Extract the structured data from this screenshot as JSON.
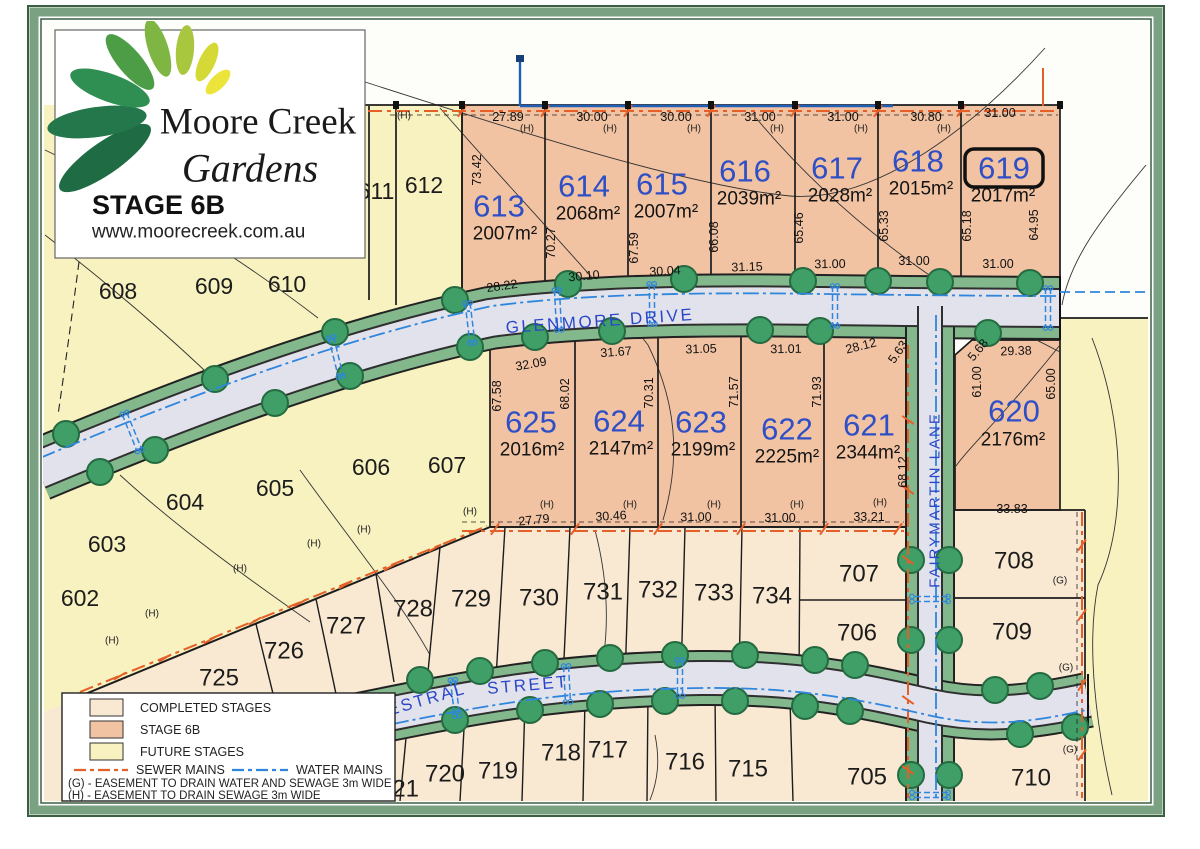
{
  "title_block": {
    "brand_line1": "Moore Creek",
    "brand_line2": "Gardens",
    "stage": "STAGE 6B",
    "website": "www.moorecreek.com.au"
  },
  "legend": {
    "completed": "COMPLETED STAGES",
    "stage6b": "STAGE 6B",
    "future": "FUTURE STAGES",
    "sewer": "SEWER MAINS",
    "water": "WATER MAINS",
    "easement_g": "(G) - EASEMENT TO DRAIN WATER AND SEWAGE 3m WIDE",
    "easement_h": "(H) - EASEMENT TO DRAIN SEWAGE 3m WIDE"
  },
  "colors": {
    "completed": "#f9e9d2",
    "stage6b": "#f2c3a2",
    "future": "#f7f2c0",
    "road": "#e2e2ec",
    "verge": "#83b88d",
    "water": "#2f86dd",
    "sewer": "#e55f28",
    "lot_number_blue": "#2e4fc6",
    "lot_number_black": "#1c1c1c"
  },
  "streets": {
    "glenmore": {
      "name": "GLENMORE DRIVE"
    },
    "kestral_a": {
      "name": "KESTRAL"
    },
    "kestral_b": {
      "name": "STREET"
    },
    "fairymartin": {
      "name": "FAIRYMARTIN LANE"
    }
  },
  "map": {
    "highlighted_lot": "619",
    "stage6b_lots": [
      {
        "id": "613",
        "area": "2007m²",
        "nx": 499,
        "ny": 206,
        "ax": 505,
        "ay": 234
      },
      {
        "id": "614",
        "area": "2068m²",
        "nx": 584,
        "ny": 186,
        "ax": 588,
        "ay": 214
      },
      {
        "id": "615",
        "area": "2007m²",
        "nx": 662,
        "ny": 184,
        "ax": 666,
        "ay": 212
      },
      {
        "id": "616",
        "area": "2039m²",
        "nx": 745,
        "ny": 171,
        "ax": 749,
        "ay": 199
      },
      {
        "id": "617",
        "area": "2028m²",
        "nx": 837,
        "ny": 168,
        "ax": 840,
        "ay": 196
      },
      {
        "id": "618",
        "area": "2015m²",
        "nx": 918,
        "ny": 161,
        "ax": 921,
        "ay": 189
      },
      {
        "id": "619",
        "area": "2017m²",
        "nx": 1004,
        "ny": 168,
        "ax": 1003,
        "ay": 196,
        "boxed": true
      },
      {
        "id": "620",
        "area": "2176m²",
        "nx": 1014,
        "ny": 411,
        "ax": 1013,
        "ay": 440
      },
      {
        "id": "621",
        "area": "2344m²",
        "nx": 869,
        "ny": 425,
        "ax": 868,
        "ay": 453
      },
      {
        "id": "622",
        "area": "2225m²",
        "nx": 787,
        "ny": 429,
        "ax": 787,
        "ay": 457
      },
      {
        "id": "623",
        "area": "2199m²",
        "nx": 701,
        "ny": 422,
        "ax": 703,
        "ay": 450
      },
      {
        "id": "624",
        "area": "2147m²",
        "nx": 619,
        "ny": 421,
        "ax": 621,
        "ay": 449
      },
      {
        "id": "625",
        "area": "2016m²",
        "nx": 531,
        "ny": 422,
        "ax": 532,
        "ay": 450
      }
    ],
    "completed_lots": [
      {
        "id": "705",
        "x": 867,
        "y": 777
      },
      {
        "id": "706",
        "x": 857,
        "y": 633
      },
      {
        "id": "707",
        "x": 859,
        "y": 574
      },
      {
        "id": "708",
        "x": 1014,
        "y": 561
      },
      {
        "id": "709",
        "x": 1012,
        "y": 632
      },
      {
        "id": "710",
        "x": 1031,
        "y": 778
      },
      {
        "id": "715",
        "x": 748,
        "y": 769
      },
      {
        "id": "716",
        "x": 685,
        "y": 762
      },
      {
        "id": "717",
        "x": 608,
        "y": 750
      },
      {
        "id": "718",
        "x": 561,
        "y": 753
      },
      {
        "id": "719",
        "x": 498,
        "y": 771
      },
      {
        "id": "720",
        "x": 445,
        "y": 774
      },
      {
        "id": "721",
        "x": 399,
        "y": 789
      },
      {
        "id": "725",
        "x": 219,
        "y": 678
      },
      {
        "id": "726",
        "x": 284,
        "y": 651
      },
      {
        "id": "727",
        "x": 346,
        "y": 626
      },
      {
        "id": "728",
        "x": 413,
        "y": 609
      },
      {
        "id": "729",
        "x": 471,
        "y": 599
      },
      {
        "id": "730",
        "x": 539,
        "y": 598
      },
      {
        "id": "731",
        "x": 603,
        "y": 592
      },
      {
        "id": "732",
        "x": 658,
        "y": 590
      },
      {
        "id": "733",
        "x": 714,
        "y": 593
      },
      {
        "id": "734",
        "x": 772,
        "y": 596
      }
    ],
    "future_lots": [
      {
        "id": "602",
        "x": 80,
        "y": 598
      },
      {
        "id": "603",
        "x": 107,
        "y": 544
      },
      {
        "id": "604",
        "x": 185,
        "y": 502
      },
      {
        "id": "605",
        "x": 275,
        "y": 488
      },
      {
        "id": "606",
        "x": 371,
        "y": 467
      },
      {
        "id": "607",
        "x": 447,
        "y": 465
      },
      {
        "id": "608",
        "x": 118,
        "y": 291
      },
      {
        "id": "609",
        "x": 214,
        "y": 286
      },
      {
        "id": "610",
        "x": 287,
        "y": 284
      },
      {
        "id": "611",
        "x": 376,
        "y": 191
      },
      {
        "id": "612",
        "x": 424,
        "y": 185
      }
    ],
    "measurements": [
      {
        "t": "27.89",
        "x": 508,
        "y": 117,
        "r": 0
      },
      {
        "t": "30.00",
        "x": 592,
        "y": 117,
        "r": 0
      },
      {
        "t": "30.00",
        "x": 676,
        "y": 117,
        "r": 0
      },
      {
        "t": "31.00",
        "x": 760,
        "y": 117,
        "r": 0
      },
      {
        "t": "31.00",
        "x": 843,
        "y": 117,
        "r": 0
      },
      {
        "t": "30.80",
        "x": 926,
        "y": 117,
        "r": 0
      },
      {
        "t": "31.00",
        "x": 1000,
        "y": 113,
        "r": 0
      },
      {
        "t": "28.22",
        "x": 502,
        "y": 286,
        "r": -8
      },
      {
        "t": "30.10",
        "x": 584,
        "y": 276,
        "r": -5
      },
      {
        "t": "30.04",
        "x": 665,
        "y": 271,
        "r": -3
      },
      {
        "t": "31.15",
        "x": 747,
        "y": 267,
        "r": -2
      },
      {
        "t": "31.00",
        "x": 830,
        "y": 264,
        "r": -1
      },
      {
        "t": "31.00",
        "x": 914,
        "y": 261,
        "r": 0
      },
      {
        "t": "31.00",
        "x": 998,
        "y": 264,
        "r": 0
      },
      {
        "t": "73.42",
        "x": 477,
        "y": 170,
        "r": -90
      },
      {
        "t": "70.27",
        "x": 551,
        "y": 243,
        "r": -90
      },
      {
        "t": "67.59",
        "x": 634,
        "y": 248,
        "r": -90
      },
      {
        "t": "66.08",
        "x": 714,
        "y": 237,
        "r": -90
      },
      {
        "t": "65.46",
        "x": 799,
        "y": 228,
        "r": -90
      },
      {
        "t": "65.33",
        "x": 884,
        "y": 226,
        "r": -90
      },
      {
        "t": "65.18",
        "x": 967,
        "y": 226,
        "r": -90
      },
      {
        "t": "64.95",
        "x": 1034,
        "y": 225,
        "r": -90
      },
      {
        "t": "32.09",
        "x": 531,
        "y": 364,
        "r": -10
      },
      {
        "t": "31.67",
        "x": 616,
        "y": 352,
        "r": -4
      },
      {
        "t": "31.05",
        "x": 701,
        "y": 349,
        "r": -2
      },
      {
        "t": "31.01",
        "x": 786,
        "y": 349,
        "r": -1
      },
      {
        "t": "28.12",
        "x": 861,
        "y": 346,
        "r": -14
      },
      {
        "t": "5.63",
        "x": 898,
        "y": 352,
        "r": -55
      },
      {
        "t": "5.68",
        "x": 978,
        "y": 350,
        "r": -50
      },
      {
        "t": "29.38",
        "x": 1016,
        "y": 351,
        "r": -2
      },
      {
        "t": "61.00",
        "x": 977,
        "y": 382,
        "r": -90
      },
      {
        "t": "65.00",
        "x": 1051,
        "y": 384,
        "r": -90
      },
      {
        "t": "67.58",
        "x": 497,
        "y": 396,
        "r": -90
      },
      {
        "t": "68.02",
        "x": 565,
        "y": 394,
        "r": -90
      },
      {
        "t": "70.31",
        "x": 649,
        "y": 393,
        "r": -90
      },
      {
        "t": "71.57",
        "x": 734,
        "y": 392,
        "r": -90
      },
      {
        "t": "71.93",
        "x": 817,
        "y": 392,
        "r": -90
      },
      {
        "t": "68.12",
        "x": 903,
        "y": 472,
        "r": -90
      },
      {
        "t": "27.79",
        "x": 534,
        "y": 520,
        "r": -6
      },
      {
        "t": "30.46",
        "x": 611,
        "y": 516,
        "r": -3
      },
      {
        "t": "31.00",
        "x": 696,
        "y": 517,
        "r": -1
      },
      {
        "t": "31.00",
        "x": 780,
        "y": 518,
        "r": 0
      },
      {
        "t": "33.21",
        "x": 869,
        "y": 517,
        "r": 0
      },
      {
        "t": "33.83",
        "x": 1012,
        "y": 509,
        "r": 0
      }
    ],
    "easement_labels": [
      {
        "t": "(H)",
        "x": 404,
        "y": 116
      },
      {
        "t": "(H)",
        "x": 527,
        "y": 129
      },
      {
        "t": "(H)",
        "x": 610,
        "y": 129
      },
      {
        "t": "(H)",
        "x": 694,
        "y": 129
      },
      {
        "t": "(H)",
        "x": 777,
        "y": 129
      },
      {
        "t": "(H)",
        "x": 861,
        "y": 129
      },
      {
        "t": "(H)",
        "x": 944,
        "y": 129
      },
      {
        "t": "(H)",
        "x": 470,
        "y": 512
      },
      {
        "t": "(H)",
        "x": 547,
        "y": 505
      },
      {
        "t": "(H)",
        "x": 630,
        "y": 505
      },
      {
        "t": "(H)",
        "x": 714,
        "y": 505
      },
      {
        "t": "(H)",
        "x": 797,
        "y": 505
      },
      {
        "t": "(H)",
        "x": 880,
        "y": 503
      },
      {
        "t": "(H)",
        "x": 112,
        "y": 641
      },
      {
        "t": "(H)",
        "x": 152,
        "y": 614
      },
      {
        "t": "(H)",
        "x": 240,
        "y": 569
      },
      {
        "t": "(H)",
        "x": 314,
        "y": 544
      },
      {
        "t": "(H)",
        "x": 364,
        "y": 530
      },
      {
        "t": "(G)",
        "x": 1060,
        "y": 581
      },
      {
        "t": "(G)",
        "x": 1066,
        "y": 668
      },
      {
        "t": "(G)",
        "x": 1070,
        "y": 750
      }
    ]
  }
}
